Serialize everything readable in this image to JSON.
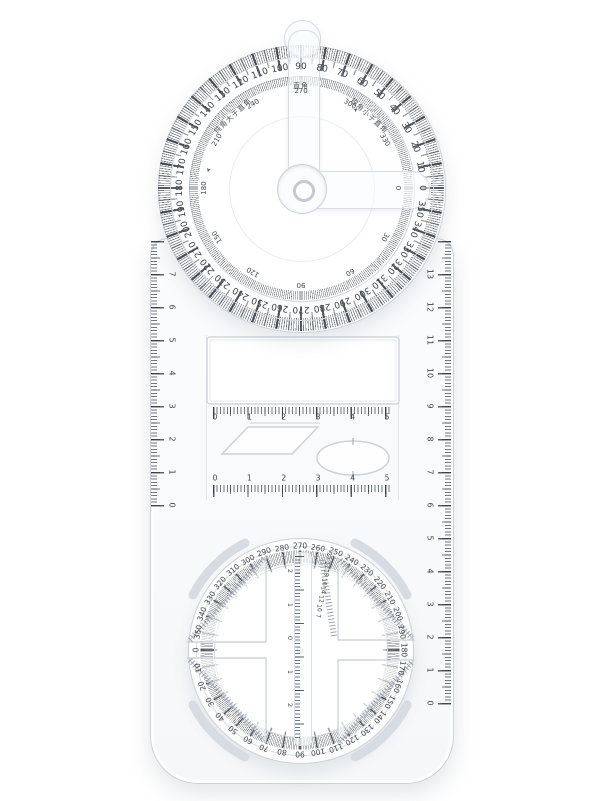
{
  "colors": {
    "plastic_edge": "#ccd2d9",
    "tick": "#3e444d",
    "text": "#3f454c",
    "background": "#ffffff"
  },
  "top_protractor": {
    "outer_degree_labels": [
      "0",
      "10",
      "20",
      "30",
      "40",
      "50",
      "60",
      "70",
      "80",
      "90",
      "100",
      "110",
      "120",
      "130",
      "140",
      "150",
      "160",
      "170",
      "180",
      "190",
      "200",
      "210",
      "220",
      "230",
      "240",
      "250",
      "260",
      "270",
      "280",
      "290",
      "300",
      "310",
      "320",
      "330",
      "340",
      "350"
    ],
    "inner_degree_labels": [
      "0",
      "30",
      "60",
      "90",
      "120",
      "150",
      "180",
      "210",
      "240",
      "270",
      "300",
      "330"
    ],
    "right_angle_label": "直角",
    "obtuse_arc_label": "钝角大于直角",
    "acute_arc_label": "锐角小于直角",
    "obtuse_arrow": "➤",
    "acute_arrow": "➤"
  },
  "left_ruler": {
    "cm_labels": [
      "0",
      "1",
      "2",
      "3",
      "4",
      "5",
      "6",
      "7"
    ]
  },
  "right_ruler": {
    "cm_labels": [
      "0",
      "1",
      "2",
      "3",
      "4",
      "5",
      "6",
      "7",
      "8",
      "9",
      "10",
      "11",
      "12",
      "13"
    ]
  },
  "middle_panel": {
    "top_scale_labels": [
      "0",
      "1",
      "2",
      "3",
      "4",
      "5"
    ],
    "bottom_scale_labels": [
      "0",
      "1",
      "2",
      "3",
      "4",
      "5"
    ]
  },
  "bottom_dial": {
    "degree_labels": [
      "0",
      "10",
      "20",
      "30",
      "40",
      "50",
      "60",
      "70",
      "80",
      "90",
      "100",
      "110",
      "120",
      "130",
      "140",
      "150",
      "160",
      "170",
      "180",
      "190",
      "200",
      "210",
      "220",
      "230",
      "240",
      "250",
      "260",
      "270",
      "280",
      "290",
      "300",
      "310",
      "320",
      "330",
      "340",
      "350"
    ],
    "center_ruler_labels": [
      "2",
      "1",
      "0",
      "1",
      "2"
    ],
    "circle_size_labels": [
      "25",
      "22",
      "19",
      "16",
      "14",
      "12",
      "10",
      "7"
    ]
  }
}
